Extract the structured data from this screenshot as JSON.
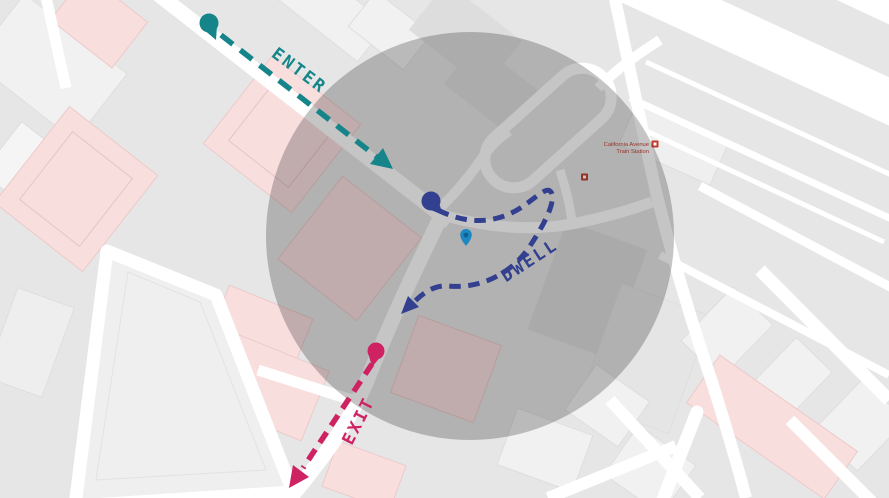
{
  "annotations": {
    "enter": {
      "label": "ENTER",
      "color": "#16858a"
    },
    "dwell": {
      "label": "DWELL",
      "color": "#32408f"
    },
    "exit": {
      "label": "EXIT",
      "color": "#ce2262"
    }
  },
  "map": {
    "station": {
      "name_line1": "California Avenue",
      "name_line2": "Train Station",
      "label_color": "#c0392b"
    },
    "icons": [
      {
        "name": "train-station-icon",
        "color": "#c0392b"
      },
      {
        "name": "train-station-icon",
        "color": "#c0392b"
      },
      {
        "name": "location-pin-icon",
        "color": "#1d87c2"
      }
    ],
    "colors": {
      "land": "#e7e6e6",
      "road": "#ffffff",
      "building": "#f2f1f1",
      "building_dark": "#dedddd",
      "building_pink": "#f9dede",
      "geofence_overlay": "rgba(30,30,30,0.26)"
    }
  }
}
